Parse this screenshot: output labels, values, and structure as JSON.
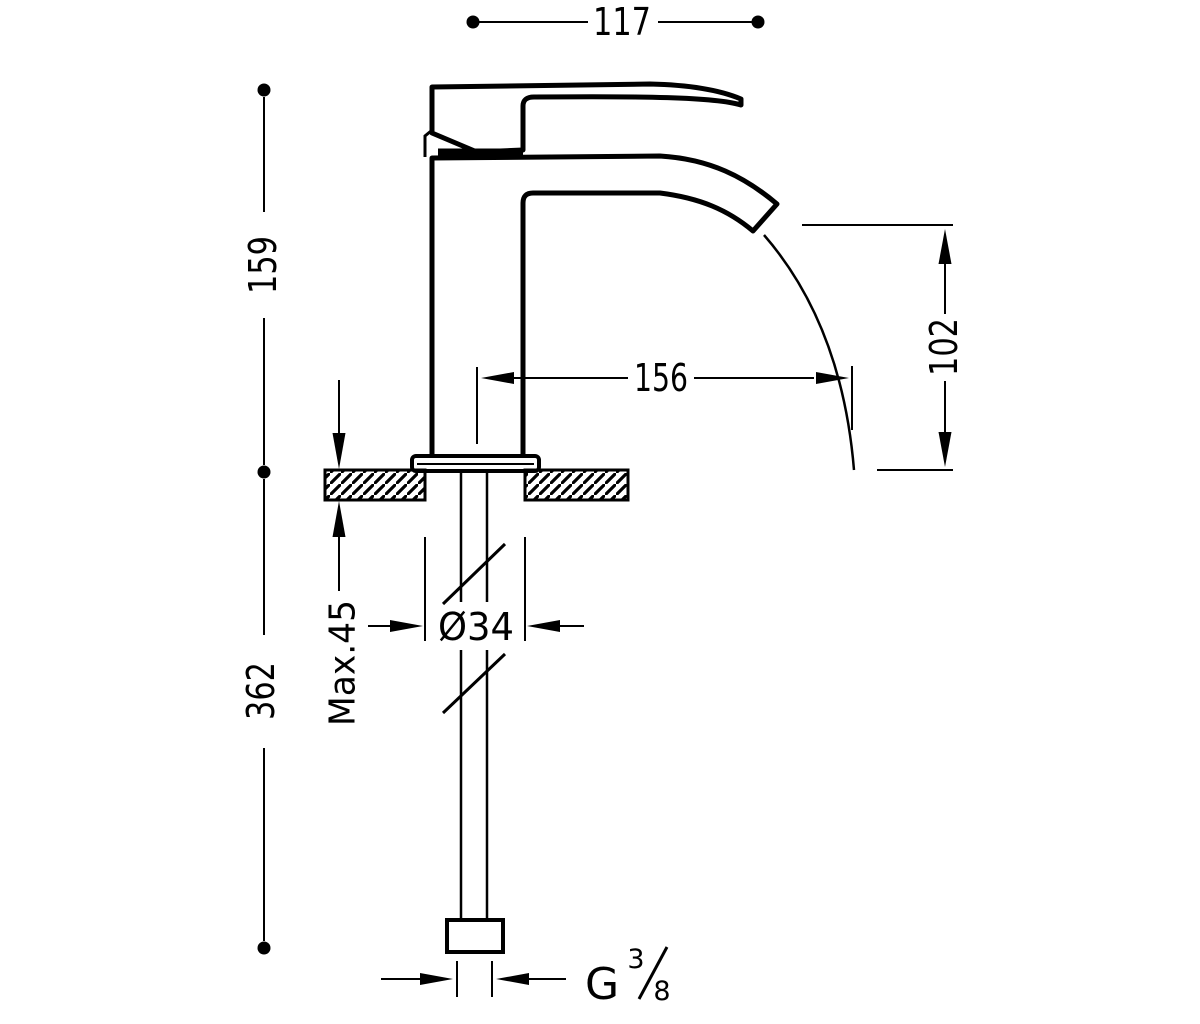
{
  "drawing": {
    "subject": "Single-lever basin mixer tap - dimensioned side elevation",
    "units": "mm",
    "background_color": "#ffffff",
    "line_color": "#000000",
    "labels": {
      "width_top": "117",
      "height_above_deck": "159",
      "height_below_deck": "362",
      "max_deck_thickness": "Max.45",
      "hole_diameter": "Ø34",
      "spout_reach": "156",
      "spout_drop_height": "102",
      "thread_prefix": "G",
      "thread_numerator": "3",
      "thread_denominator": "8"
    }
  }
}
